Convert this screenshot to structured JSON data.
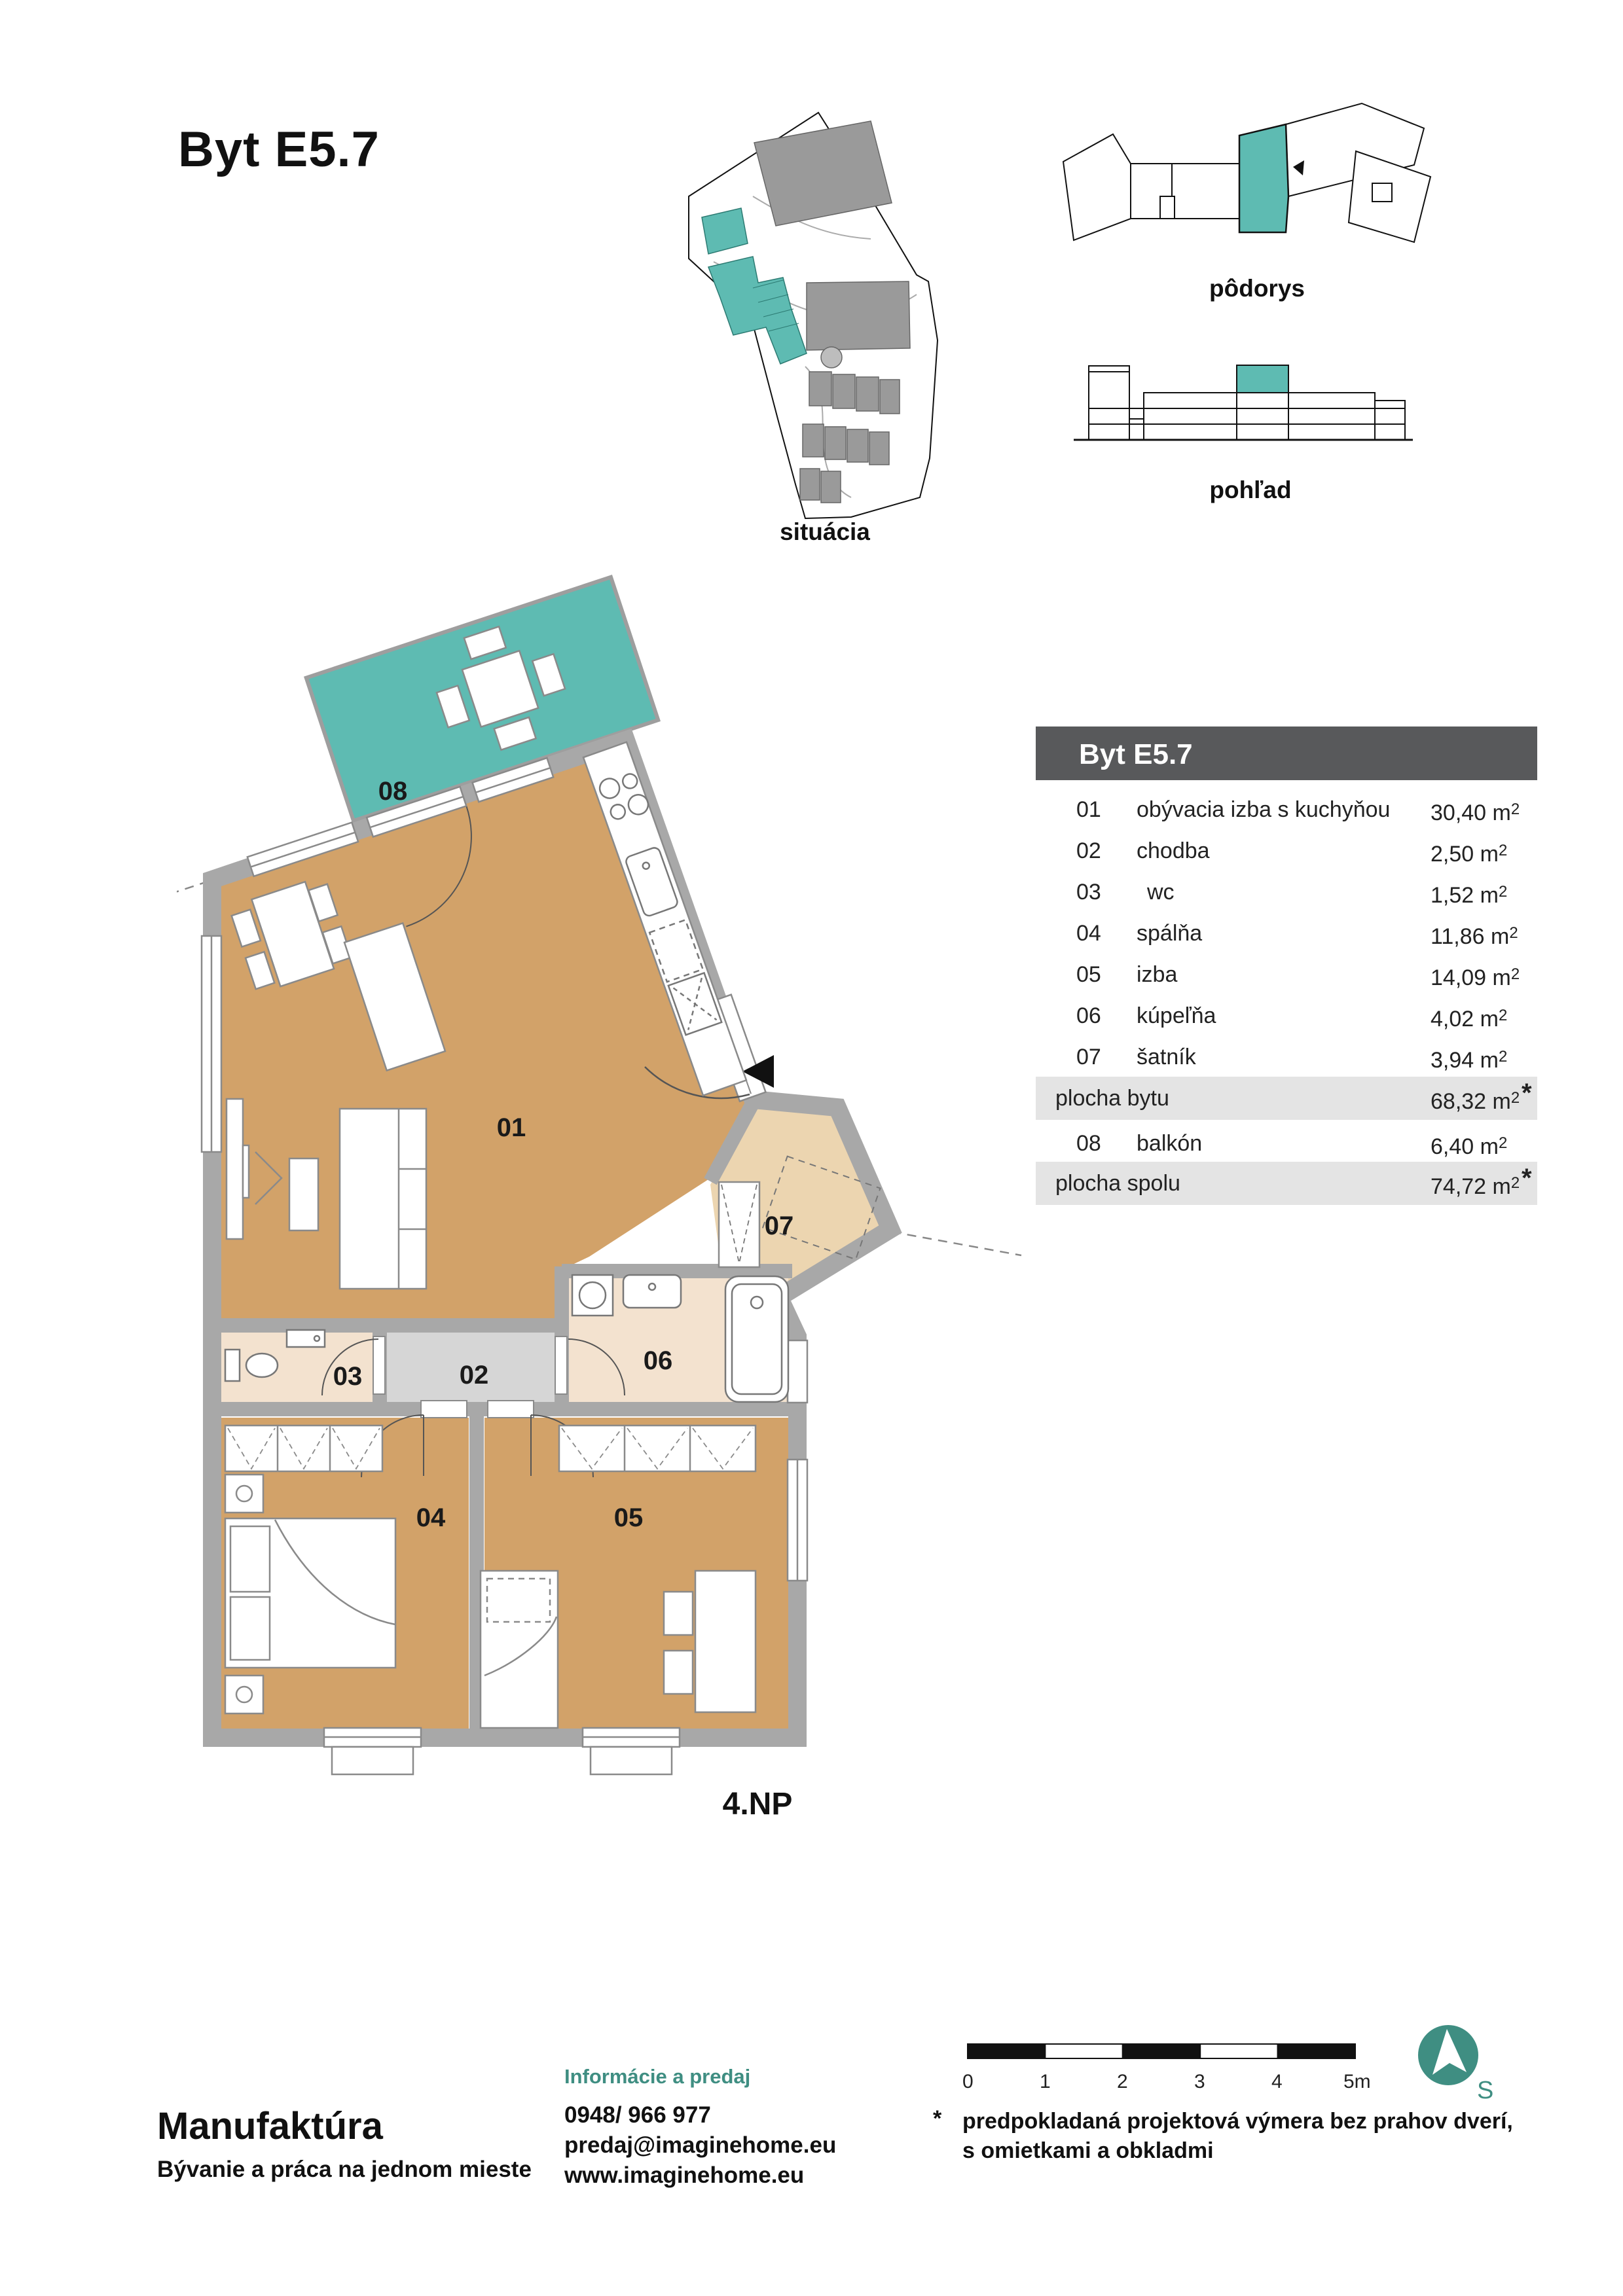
{
  "title": "Byt E5.7",
  "thumbs": {
    "site_label": "situácia",
    "plan_label": "pôdorys",
    "elevation_label": "pohľad"
  },
  "table": {
    "header": "Byt E5.7",
    "unit": "m",
    "sup": "2",
    "star": "*",
    "rows": [
      {
        "num": "01",
        "name": "obývacia izba s kuchyňou",
        "value": "30,40"
      },
      {
        "num": "02",
        "name": "chodba",
        "value": "2,50"
      },
      {
        "num": "03",
        "name": "wc",
        "value": "1,52"
      },
      {
        "num": "04",
        "name": "spálňa",
        "value": "11,86"
      },
      {
        "num": "05",
        "name": "izba",
        "value": "14,09"
      },
      {
        "num": "06",
        "name": "kúpeľňa",
        "value": "4,02"
      },
      {
        "num": "07",
        "name": "šatník",
        "value": "3,94"
      }
    ],
    "area_flat": {
      "name": "plocha bytu",
      "value": "68,32"
    },
    "balcony_row": {
      "num": "08",
      "name": "balkón",
      "value": "6,40"
    },
    "area_total": {
      "name": "plocha spolu",
      "value": "74,72"
    }
  },
  "plan": {
    "labels": {
      "l01": "01",
      "l02": "02",
      "l03": "03",
      "l04": "04",
      "l05": "05",
      "l06": "06",
      "l07": "07",
      "l08": "08"
    },
    "floor_label": "4.NP",
    "colors": {
      "room": "#d2a269",
      "wardrobe_room": "#ecd5b0",
      "bath": "#f3e2cf",
      "corridor": "#d6d6d6",
      "balcony": "#5ebbb2",
      "wall": "#a8a8a8"
    }
  },
  "scalebar": {
    "labels": [
      "0",
      "1",
      "2",
      "3",
      "4",
      "5m"
    ]
  },
  "north": {
    "letter": "S",
    "color": "#3f8e82"
  },
  "disclaimer": {
    "star": "*",
    "line1": "predpokladaná projektová výmera bez prahov dverí,",
    "line2": "s omietkami a obkladmi"
  },
  "footer": {
    "brand": "Manufaktúra",
    "tagline": "Bývanie a práca na jednom mieste",
    "info_heading": "Informácie a predaj",
    "phone": "0948/ 966 977",
    "email": "predaj@imaginehome.eu",
    "web": "www.imaginehome.eu"
  }
}
